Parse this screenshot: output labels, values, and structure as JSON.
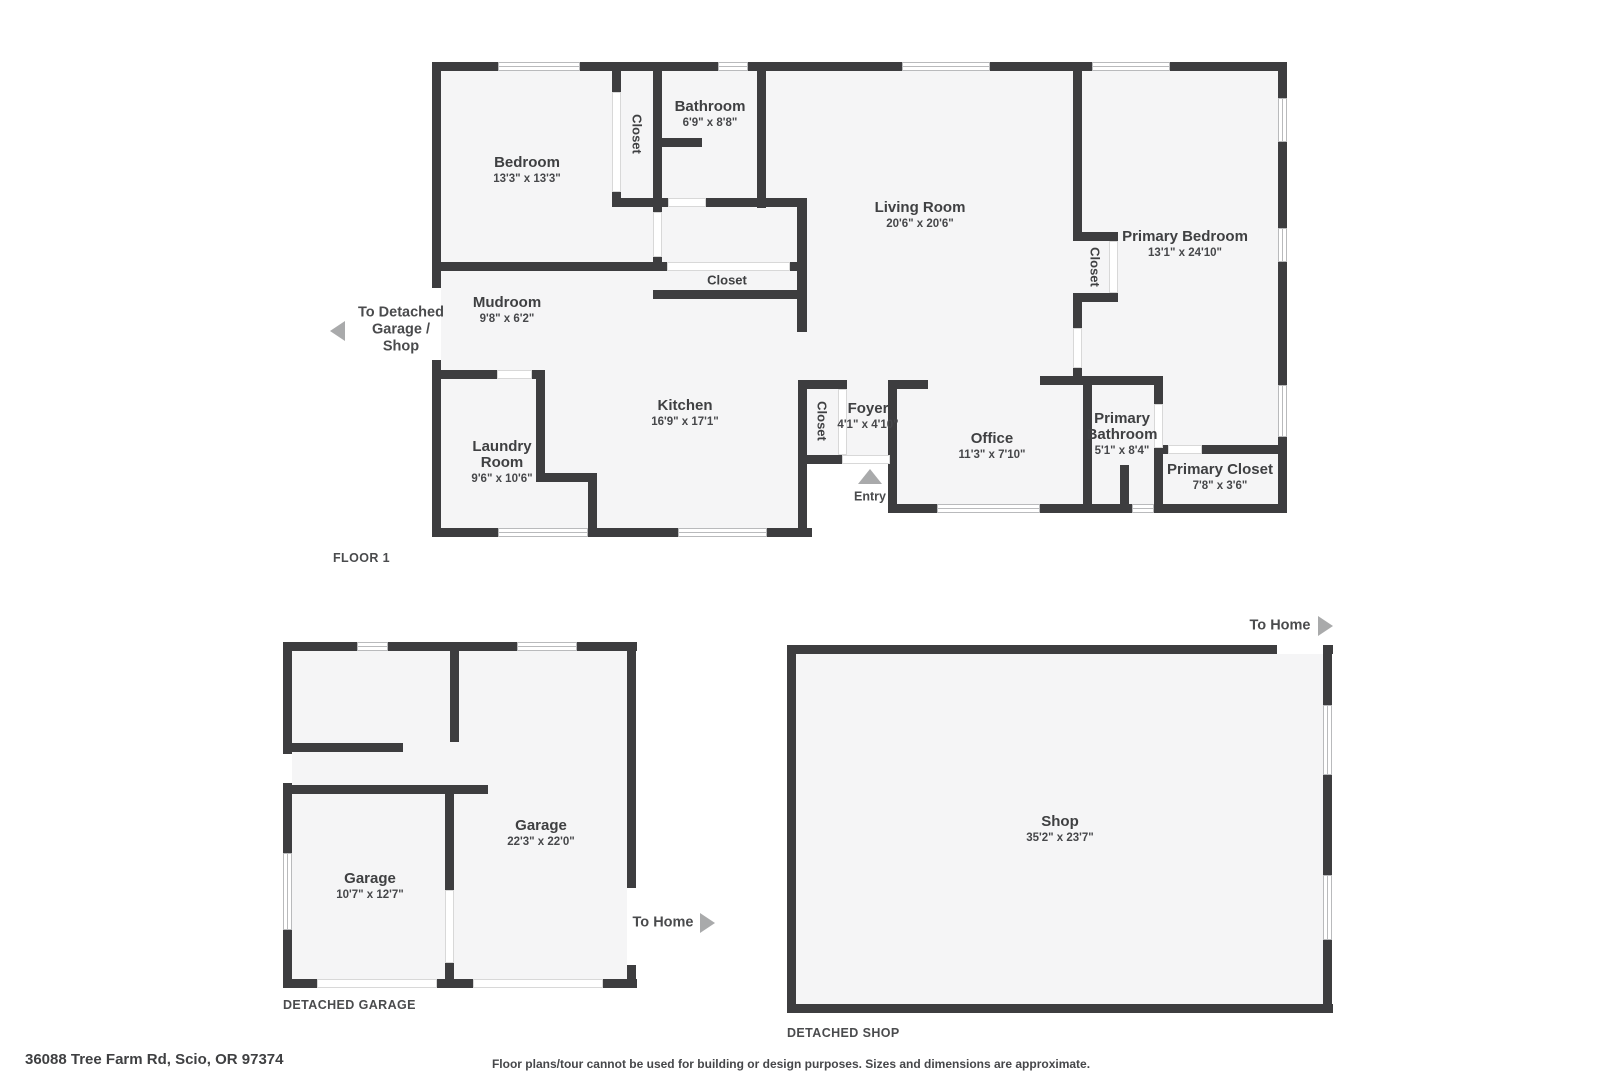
{
  "plans": {
    "floor1": {
      "title": "FLOOR 1",
      "rooms": [
        {
          "name": "Bedroom",
          "dims": "13'3\" x 13'3\""
        },
        {
          "name": "Bathroom",
          "dims": "6'9\" x 8'8\""
        },
        {
          "name": "Living Room",
          "dims": "20'6\" x 20'6\""
        },
        {
          "name": "Primary Bedroom",
          "dims": "13'1\" x 24'10\""
        },
        {
          "name": "Mudroom",
          "dims": "9'8\" x 6'2\""
        },
        {
          "name": "Kitchen",
          "dims": "16'9\" x 17'1\""
        },
        {
          "name": "Laundry Room",
          "dims": "9'6\" x 10'6\""
        },
        {
          "name": "Foyer",
          "dims": "4'1\" x 4'10\""
        },
        {
          "name": "Office",
          "dims": "11'3\" x 7'10\""
        },
        {
          "name": "Primary Bathroom",
          "dims": "5'1\" x 8'4\""
        },
        {
          "name": "Primary Closet",
          "dims": "7'8\" x 3'6\""
        }
      ],
      "closets": [
        "Closet",
        "Closet",
        "Closet",
        "Closet"
      ],
      "to_detached": "To Detached Garage / Shop",
      "entry": "Entry"
    },
    "garage": {
      "title": "DETACHED GARAGE",
      "rooms": [
        {
          "name": "Garage",
          "dims": "22'3\" x 22'0\""
        },
        {
          "name": "Garage",
          "dims": "10'7\" x 12'7\""
        }
      ],
      "to_home": "To Home"
    },
    "shop": {
      "title": "DETACHED SHOP",
      "rooms": [
        {
          "name": "Shop",
          "dims": "35'2\" x 23'7\""
        }
      ],
      "to_home": "To Home"
    }
  },
  "footer": {
    "address": "36088 Tree Farm Rd, Scio, OR 97374",
    "disclaimer": "Floor plans/tour cannot be used for building or design purposes. Sizes and dimensions are approximate."
  },
  "colors": {
    "wall": "#3d3d3f",
    "floor": "#f5f5f6",
    "text": "#3f4042",
    "arrow": "#a9aaab"
  }
}
